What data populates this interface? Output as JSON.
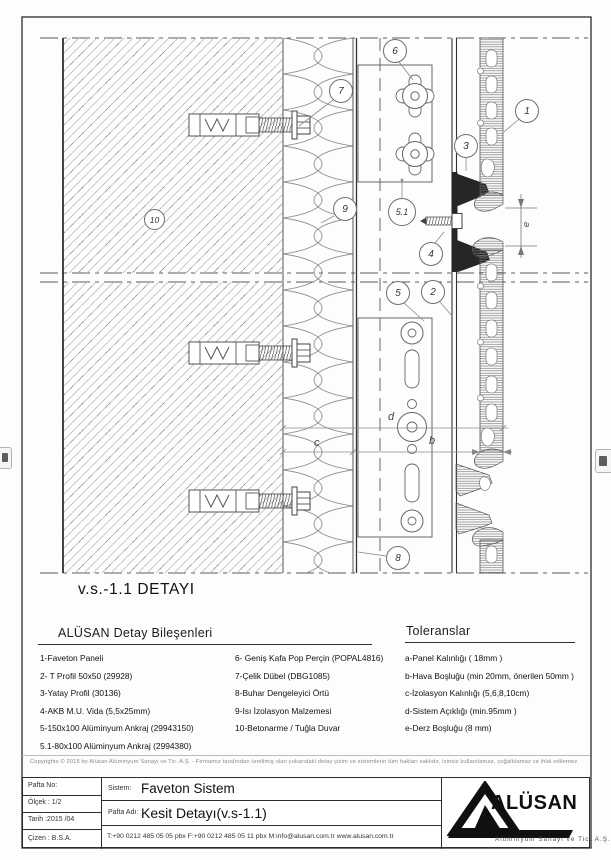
{
  "drawing": {
    "title": "v.s.-1.1 DETAYI",
    "callouts": [
      {
        "label": "6"
      },
      {
        "label": "7"
      },
      {
        "label": "1"
      },
      {
        "label": "3"
      },
      {
        "label": "9"
      },
      {
        "label": "5.1"
      },
      {
        "label": "4"
      },
      {
        "label": "5"
      },
      {
        "label": "2"
      },
      {
        "label": "8"
      },
      {
        "label": "10"
      }
    ],
    "dims": [
      {
        "label": "e"
      },
      {
        "label": "d"
      },
      {
        "label": "b"
      },
      {
        "label": "c"
      }
    ]
  },
  "components": {
    "heading": "ALÜSAN  Detay Bileşenleri",
    "col1": [
      "1-Faveton Paneli",
      "2- T Profil 50x50  (29928)",
      "3-Yatay Profil (30136)",
      "4-AKB M.U. Vida (5,5x25mm)",
      "5-150x100 Alüminyum Ankraj (29943150)",
      "5.1-80x100 Alüminyum Ankraj (2994380)"
    ],
    "col2": [
      "6- Geniş Kafa Pop Perçin (POPAL4816)",
      "7-Çelik Dübel (DBG1085)",
      "8-Buhar Dengeleyici Örtü",
      "9-Isı İzolasyon Malzemesi",
      "10-Betonarme / Tuğla Duvar"
    ]
  },
  "tolerances": {
    "heading": "Toleranslar",
    "items": [
      "a-Panel Kalınlığı ( 18mm )",
      "b-Hava Boşluğu (min 20mm, önerilen 50mm )",
      "c-İzolasyon Kalınlığı (5,6,8,10cm)",
      "d-Sistem Açıklığı (min.95mm )",
      "e-Derz Boşluğu (8 mm)"
    ]
  },
  "copyright": {
    "text": "Copyrights © 2015 by Alüsan Alüminyum Sanayi ve Tic. A.Ş. - Firmamız tarafından üretilmiş olan yukarıdaki detay çizim ve sistemlerin tüm hakları saklıdır, izinsiz kullanılamaz, çoğaltılamaz ve ihlal edilemez."
  },
  "titleblock": {
    "pafta_no_label": "Pafta No:",
    "olcek": "Ölçek : 1/2",
    "tarih": "Tarih :2015 /04",
    "cizen": "Çizen : B.S.A.",
    "sistem_label": "Sistem:",
    "sistem_value": "Faveton Sistem",
    "pafta_adi_label": "Pafta Adı:",
    "pafta_adi_value": "Kesit Detayı(v.s-1.1)",
    "contact": "T:+90 0212 485 05 05 pbx    F:+90 0212 485 05 11 pbx    M:info@alusan.com.tr    www.alusan.com.tr",
    "logo_text": "ALÜSAN",
    "logo_subtitle": "Alüminyum Sanayi ve Tic. A.Ş."
  },
  "colors": {
    "line": "#555555",
    "hatch": "#a8a8a8",
    "profile_fill": "#262626",
    "text": "#111111"
  }
}
